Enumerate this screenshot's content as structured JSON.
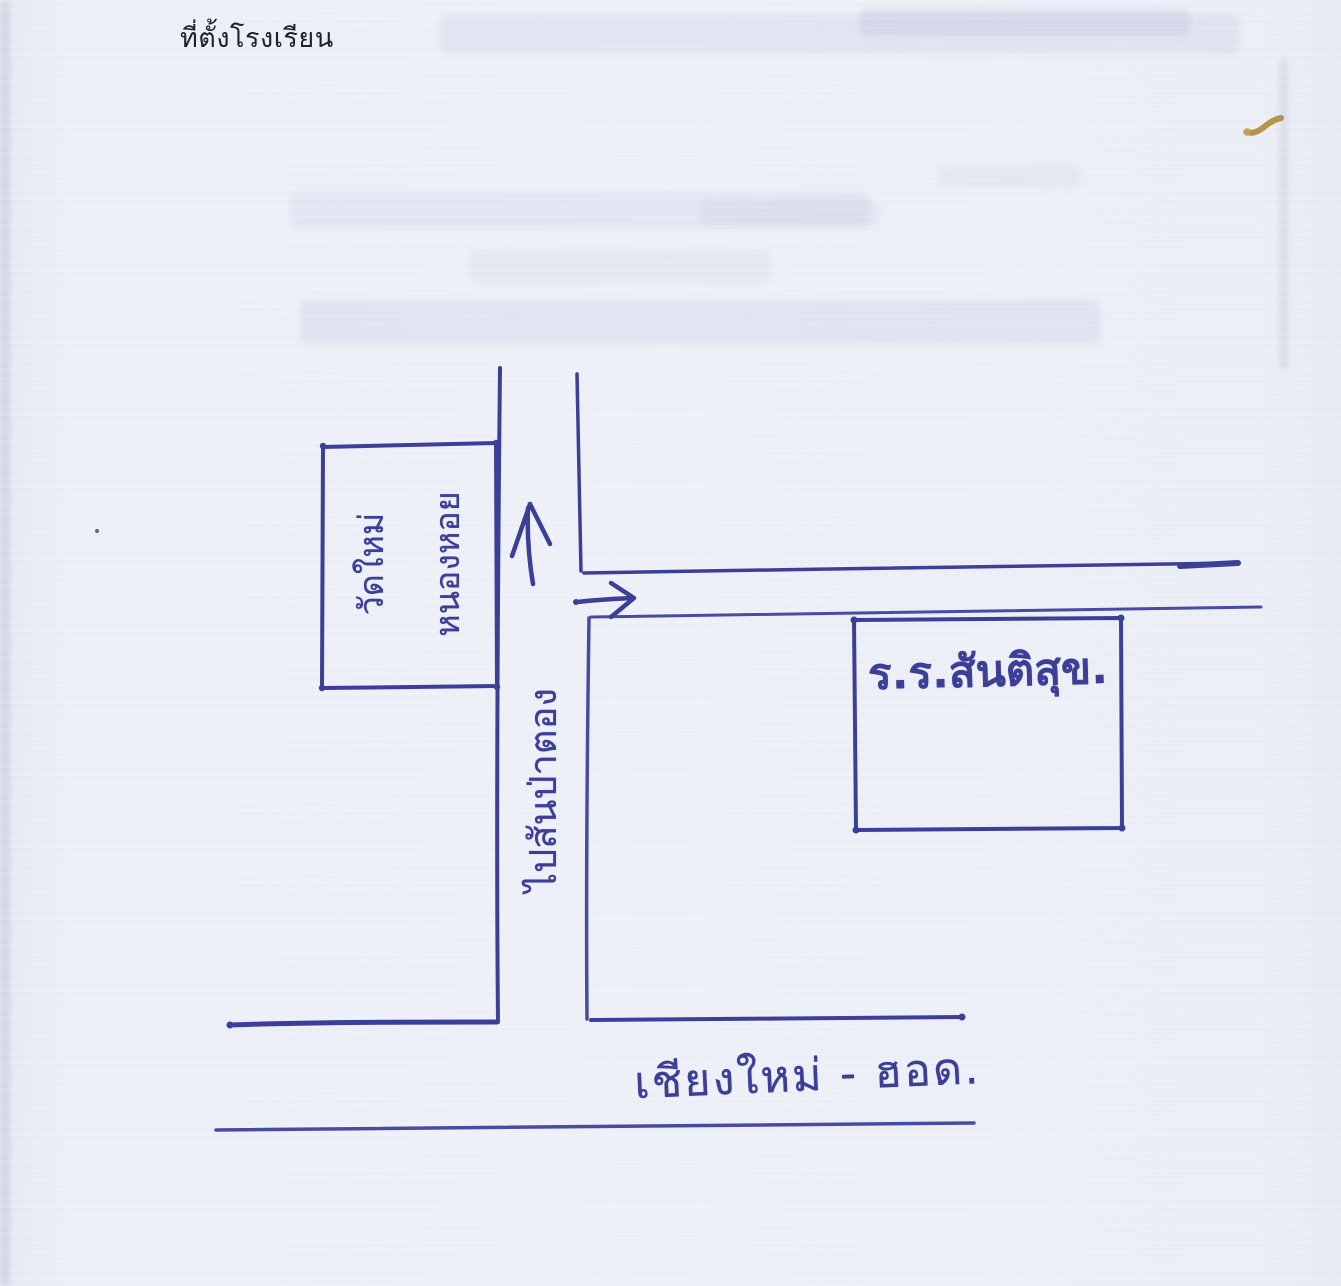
{
  "page": {
    "title": "ที่ตั้งโรงเรียน"
  },
  "map": {
    "temple_box": {
      "label_line1": "วัดใหม่",
      "label_line2": "หนองหอย"
    },
    "vertical_road": {
      "label": "ไปสันป่าตอง"
    },
    "school_box": {
      "label": "ร.ร.สันติสุข."
    },
    "highway": {
      "label": "เชียงใหม่ - ฮอด."
    },
    "icons": [
      "north-arrow-icon",
      "east-arrow-icon"
    ],
    "colors": {
      "ink": "#3b3f97",
      "paper": "#eef0f8",
      "title_text": "#20222b",
      "yellow_mark": "#b08b38"
    }
  }
}
